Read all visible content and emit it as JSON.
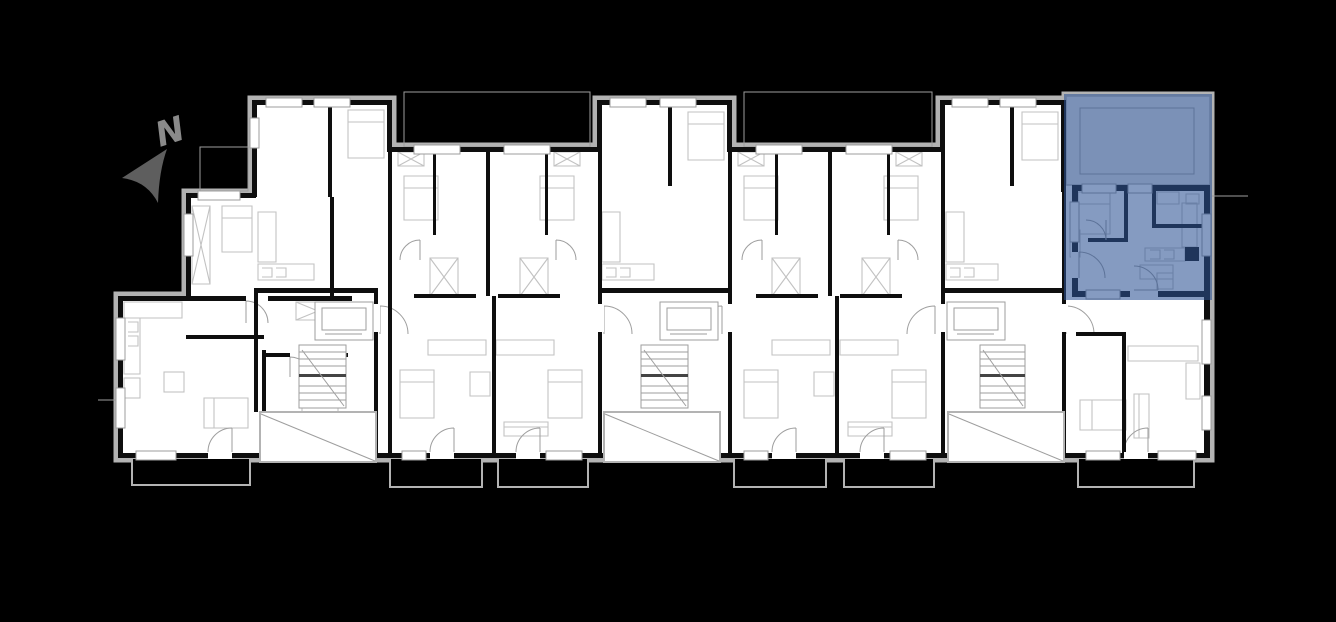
{
  "scene": {
    "background_color": "#000000",
    "description": "Apartment building floor plan with one highlighted unit"
  },
  "north_arrow": {
    "label": "N",
    "arrow_color": "#5e5e5e",
    "letter_color": "#8a8a8a"
  },
  "plan_colors": {
    "floor": "#ffffff",
    "wall": "#0e0e0e",
    "shell": "#b3b3b3",
    "detail": "#9e9e9e",
    "furniture": "#c2c2c2",
    "terrace_base": "#e8e8e8",
    "stair_landing": "#444444"
  },
  "highlighted_unit": {
    "overlay_color": "rgba(44,82,148,0.58)",
    "position": "top-right"
  }
}
